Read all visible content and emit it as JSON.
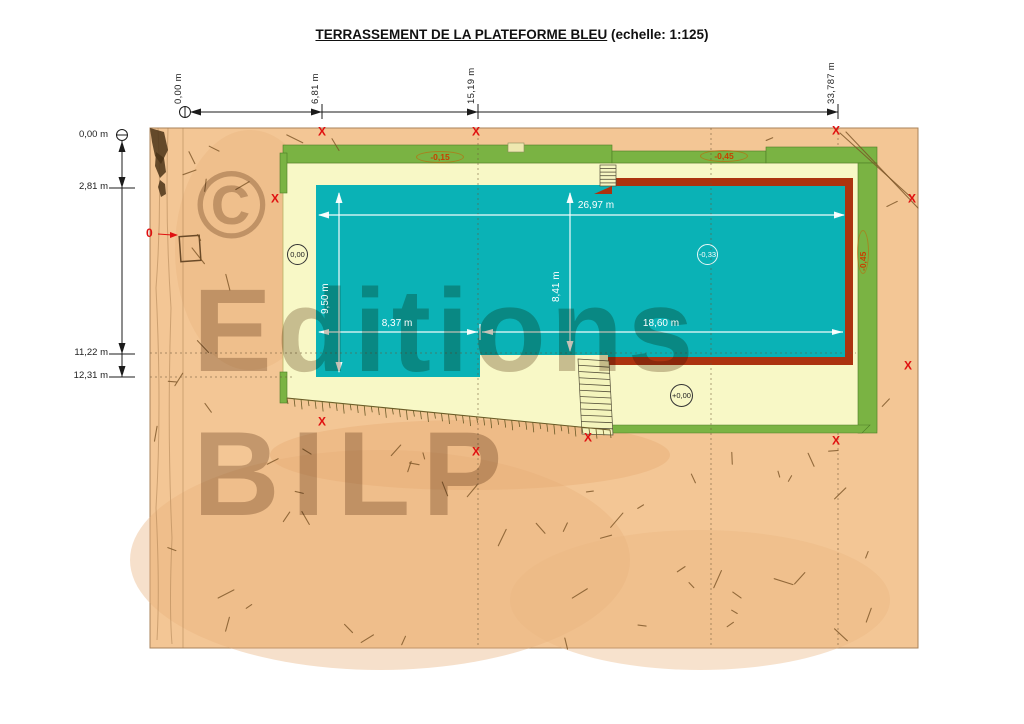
{
  "title": {
    "main": "TERRASSEMENT DE LA PLATEFORME BLEU",
    "suffix": " (echelle: 1:125)"
  },
  "watermark": {
    "symbol": "©",
    "word1": "Editions",
    "word2": "BILP"
  },
  "dimensions": {
    "top": [
      {
        "label": "0,00 m"
      },
      {
        "label": "6,81 m"
      },
      {
        "label": "15,19 m"
      },
      {
        "label": "33,787 m"
      }
    ],
    "left": [
      {
        "label": "0,00 m"
      },
      {
        "label": "2,81 m"
      },
      {
        "label": "11,22 m"
      },
      {
        "label": "12,31 m"
      }
    ],
    "pool": {
      "width_top": "26,97 m",
      "height_left": "9,50 m",
      "height_right": "8,41 m",
      "width_bottom_left": "8,37 m",
      "width_bottom_right": "18,60 m"
    }
  },
  "levels": {
    "top_strip_left": "-0,15",
    "top_strip_right": "-0,45",
    "right_strip": "-0,45"
  },
  "spot_levels": {
    "platform_left": "0,00",
    "pool_center": "-0,33",
    "platform_bottom": "+0,00"
  },
  "origin_marker": "0",
  "survey_marks": {
    "glyph": "X",
    "positions": [
      [
        322,
        132
      ],
      [
        476,
        132
      ],
      [
        836,
        131
      ],
      [
        912,
        199
      ],
      [
        275,
        199
      ],
      [
        908,
        366
      ],
      [
        322,
        422
      ],
      [
        476,
        452
      ],
      [
        588,
        438
      ],
      [
        836,
        441
      ]
    ]
  },
  "colors": {
    "terrain": "#F3C695",
    "platform": "#F8F8C6",
    "grass": "#7AB343",
    "pool": "#0AB2B6",
    "wall": "#AC330F",
    "mark_red": "#E01010",
    "level_red": "#C84000"
  }
}
